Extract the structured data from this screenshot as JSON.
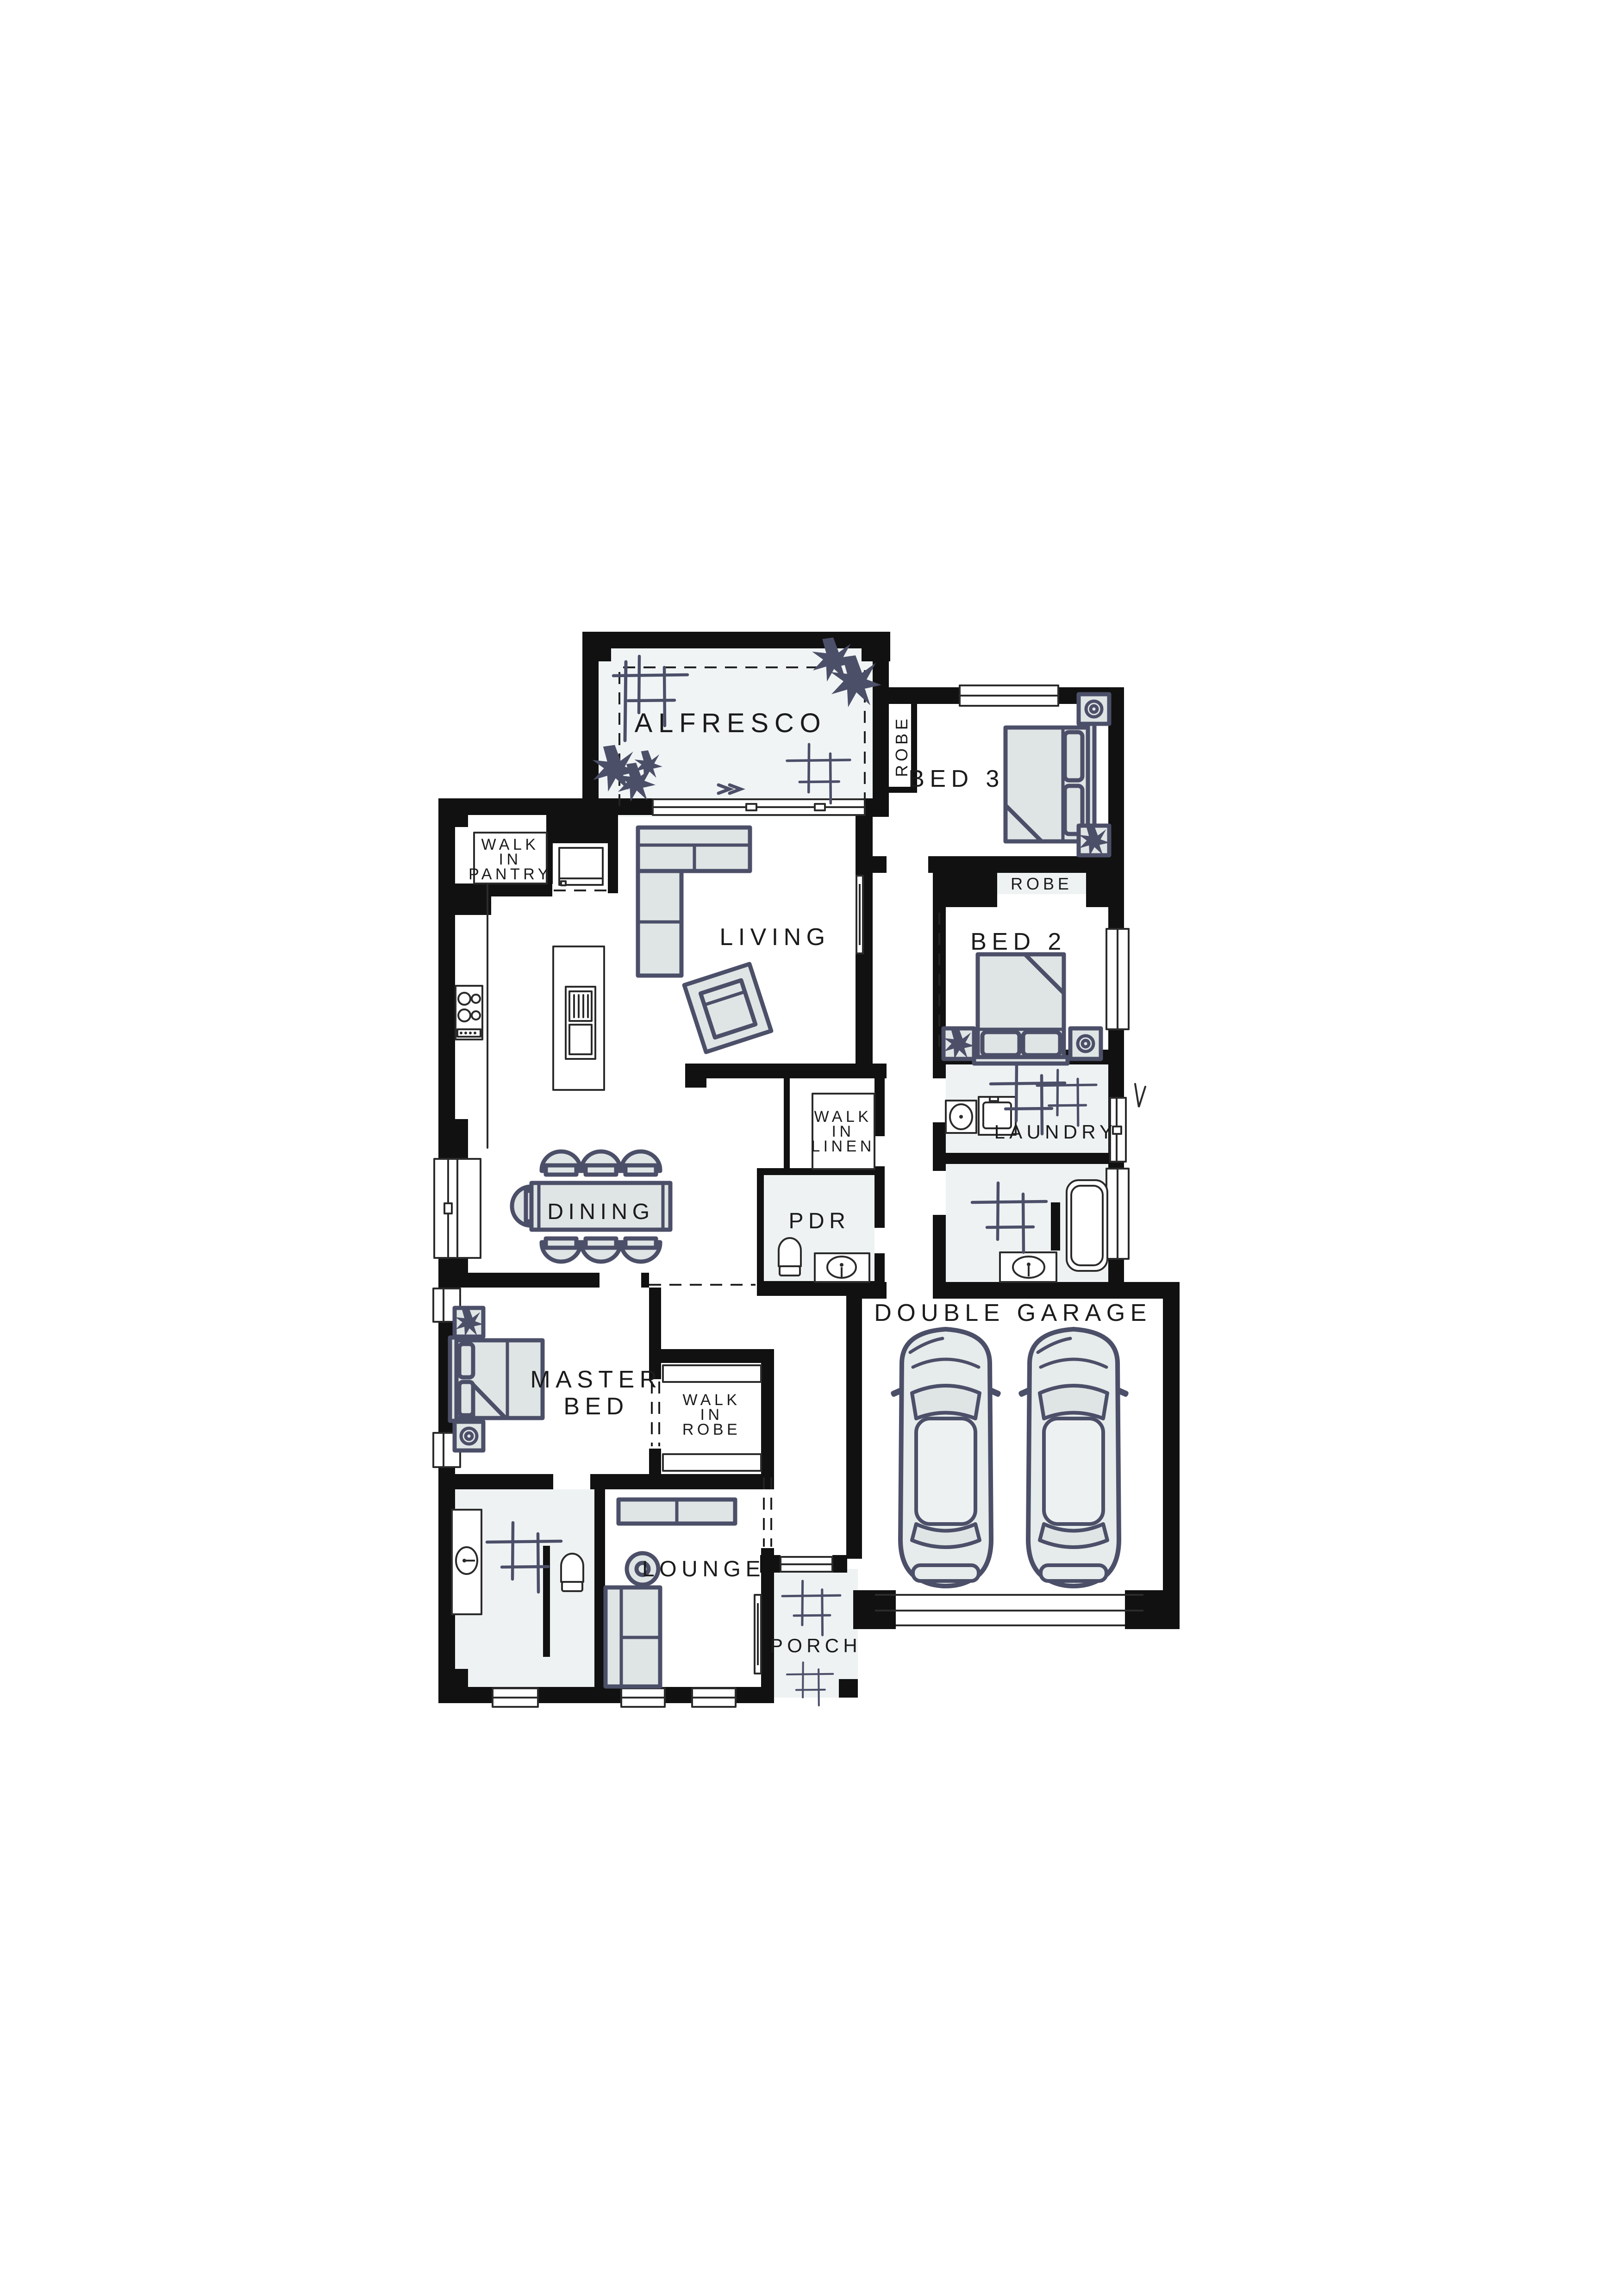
{
  "document": {
    "type": "architectural-floor-plan",
    "background": "#ffffff"
  },
  "palette": {
    "wall": "#111111",
    "room_tint": "#eef2f3",
    "alfresco_tint": "#f0f4f5",
    "furniture_fill": "#dfe5e5",
    "furniture_outline": "#4c4f68",
    "fixture_line": "#2b2b2b",
    "label_color": "#1b1b1b"
  },
  "rooms": {
    "alfresco": {
      "label": "ALFRESCO"
    },
    "bed3": {
      "label": "BED 3",
      "robe_label": "ROBE"
    },
    "bed2": {
      "label": "BED 2",
      "robe_label": "ROBE"
    },
    "walk_in_pantry": {
      "lines": [
        "WALK",
        "IN",
        "PANTRY"
      ]
    },
    "living": {
      "label": "LIVING"
    },
    "walk_in_linen": {
      "lines": [
        "WALK",
        "IN",
        "LINEN"
      ]
    },
    "pdr": {
      "label": "PDR"
    },
    "laundry": {
      "label": "LAUNDRY"
    },
    "dining": {
      "label": "DINING"
    },
    "master_bed": {
      "lines": [
        "MASTER",
        "BED"
      ]
    },
    "walk_in_robe": {
      "lines": [
        "WALK",
        "IN",
        "ROBE"
      ]
    },
    "lounge": {
      "label": "LOUNGE"
    },
    "porch": {
      "label": "PORCH"
    },
    "double_garage": {
      "label": "DOUBLE GARAGE"
    }
  }
}
